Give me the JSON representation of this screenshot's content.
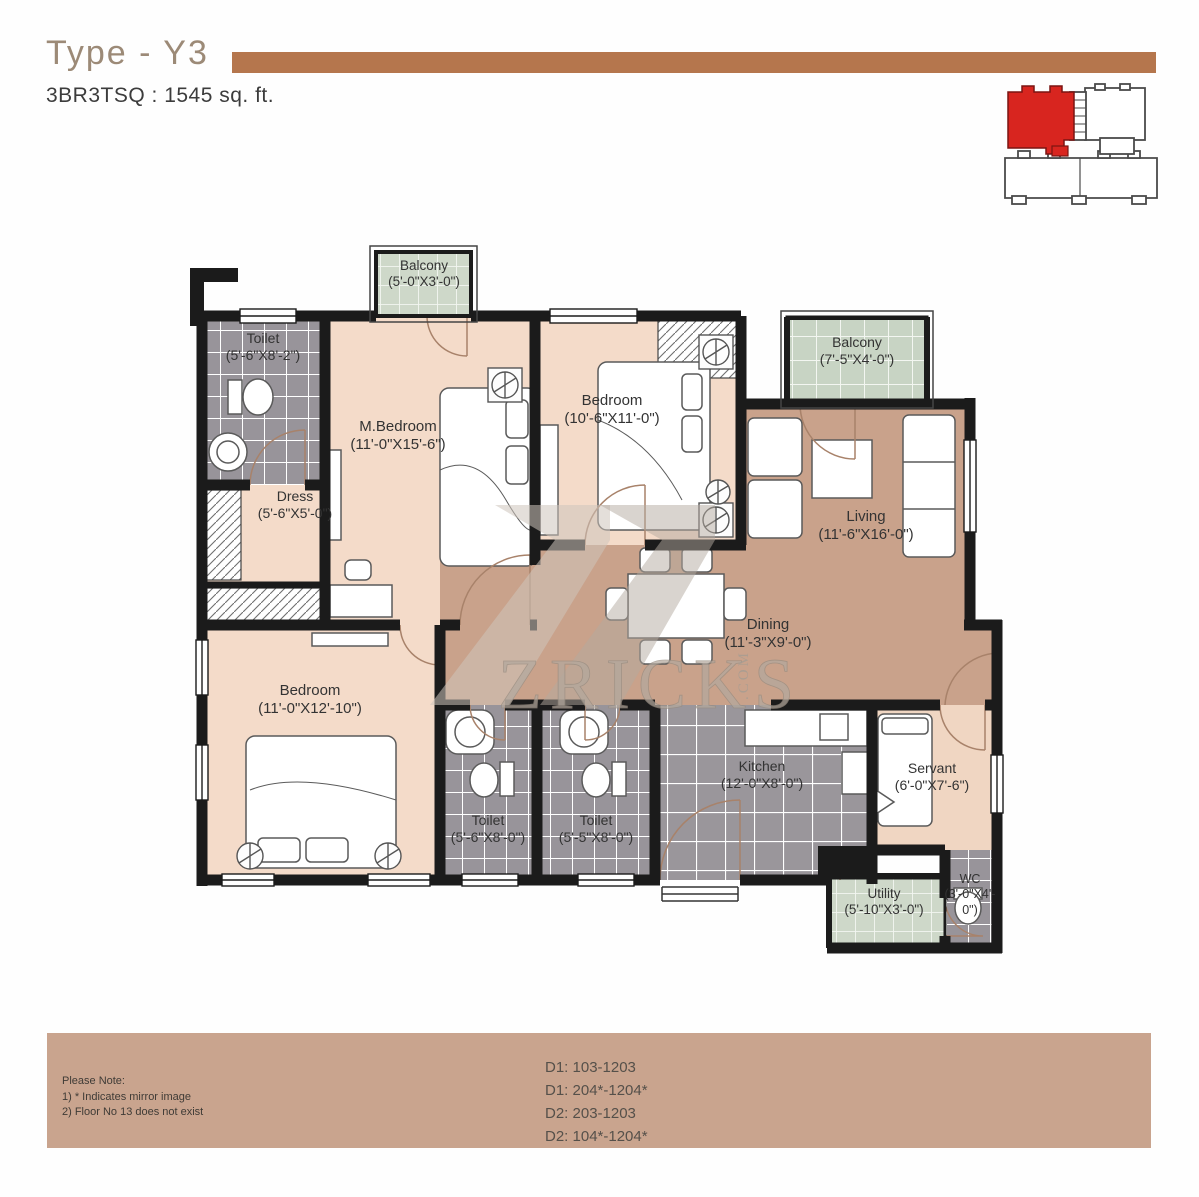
{
  "header": {
    "title": "Type - Y3",
    "subtitle": "3BR3TSQ : 1545 sq. ft."
  },
  "watermark": {
    "text": "ZRICKS",
    "suffix": ".COM"
  },
  "key_plan": {
    "highlight_color": "#d8251f"
  },
  "rooms": [
    {
      "id": "toilet-1",
      "name": "Toilet",
      "dims": "(5'-6\"X8'-2\")"
    },
    {
      "id": "balcony-1",
      "name": "Balcony",
      "dims": "(5'-0\"X3'-0\")"
    },
    {
      "id": "m-bedroom",
      "name": "M.Bedroom",
      "dims": "(11'-0\"X15'-6\")"
    },
    {
      "id": "bedroom-1",
      "name": "Bedroom",
      "dims": "(10'-6\"X11'-0\")"
    },
    {
      "id": "balcony-2",
      "name": "Balcony",
      "dims": "(7'-5\"X4'-0\")"
    },
    {
      "id": "dress",
      "name": "Dress",
      "dims": "(5'-6\"X5'-0\")"
    },
    {
      "id": "living",
      "name": "Living",
      "dims": "(11'-6\"X16'-0\")"
    },
    {
      "id": "dining",
      "name": "Dining",
      "dims": "(11'-3\"X9'-0\")"
    },
    {
      "id": "bedroom-2",
      "name": "Bedroom",
      "dims": "(11'-0\"X12'-10\")"
    },
    {
      "id": "toilet-2",
      "name": "Toilet",
      "dims": "(5'-6\"X8'-0\")"
    },
    {
      "id": "toilet-3",
      "name": "Toilet",
      "dims": "(5'-5\"X8'-0\")"
    },
    {
      "id": "kitchen",
      "name": "Kitchen",
      "dims": "(12'-0\"X8'-0\")"
    },
    {
      "id": "servant",
      "name": "Servant",
      "dims": "(6'-0\"X7'-6\")"
    },
    {
      "id": "utility",
      "name": "Utility",
      "dims": "(5'-10\"X3'-0\")"
    },
    {
      "id": "wc",
      "name": "WC",
      "dims": "(3'-0\"X4'-0\")"
    }
  ],
  "notes": {
    "heading": "Please Note:",
    "items": [
      "1)  * Indicates mirror image",
      "2)  Floor No 13 does not exist"
    ]
  },
  "units": [
    "D1: 103-1203",
    "D1: 204*-1204*",
    "D2: 203-1203",
    "D2: 104*-1204*"
  ],
  "colors": {
    "accent_bar": "#b5764d",
    "wall": "#1b1b1b",
    "floor_pink": "#f4dbc9",
    "floor_tan": "#c9a28b",
    "tile_gray": "#98949a",
    "tile_green": "#ced8c9",
    "bottom_bar": "#c9a48e",
    "key_red": "#d8251f"
  }
}
